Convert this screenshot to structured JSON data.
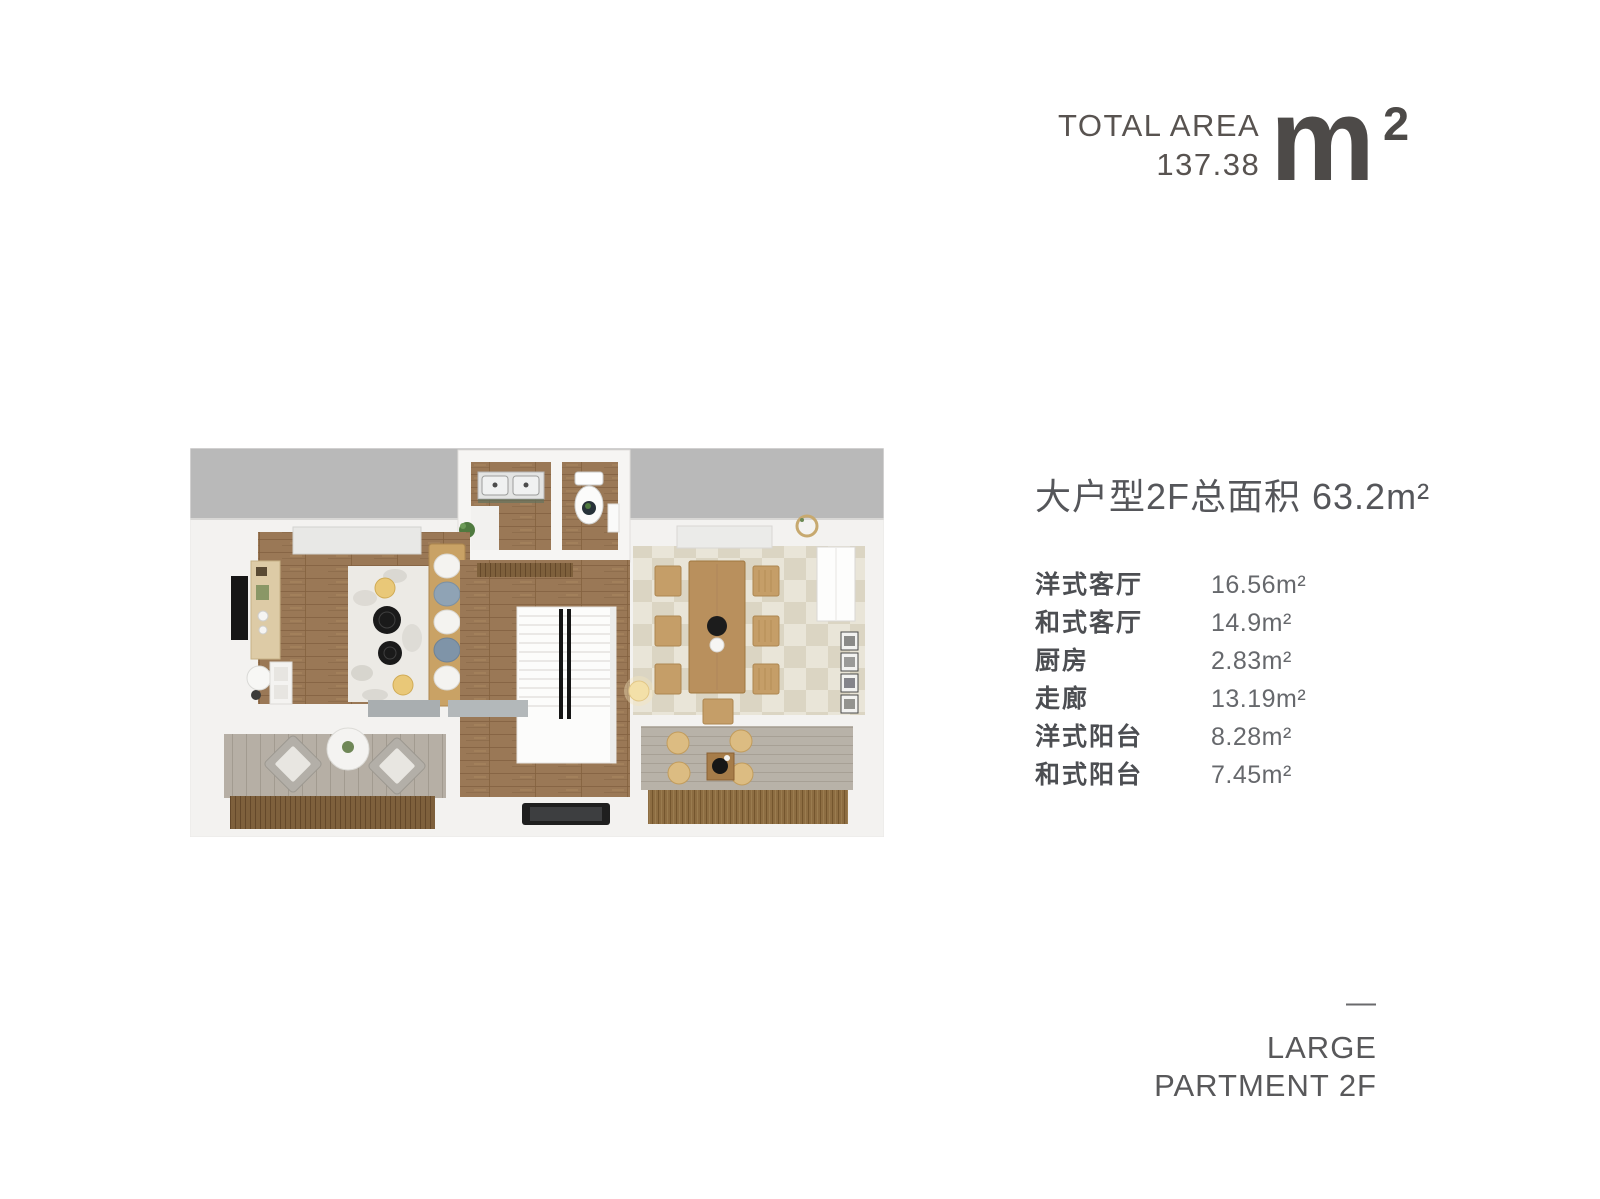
{
  "total_area": {
    "label": "TOTAL AREA",
    "value": "137.38",
    "unit_letter": "m",
    "unit_sup": "2"
  },
  "details": {
    "heading": "大户型2F总面积 63.2m²",
    "rooms": [
      {
        "label": "洋式客厅",
        "area": "16.56m²"
      },
      {
        "label": "和式客厅",
        "area": "14.9m²"
      },
      {
        "label": "厨房",
        "area": "2.83m²"
      },
      {
        "label": "走廊",
        "area": "13.19m²"
      },
      {
        "label": "洋式阳台",
        "area": "8.28m²"
      },
      {
        "label": "和式阳台",
        "area": "7.45m²"
      }
    ]
  },
  "footer": {
    "dash": "—",
    "line1": "LARGE",
    "line2": "PARTMENT 2F"
  },
  "floorplan": {
    "name": "3d-top-down-floor-plan-large-apartment-2f",
    "colors": {
      "outside_gray": "#b9b9b9",
      "wall_white": "#f3f2f0",
      "wood_floor": "#9a7856",
      "tile_light": "#e9e5d8",
      "tile_dark": "#dbd5c3",
      "deck_gray": "#b6afa5",
      "slat_brown": "#7e603c",
      "tatami_brown": "#8d6d42",
      "text_dark": "#4d4a48"
    }
  }
}
